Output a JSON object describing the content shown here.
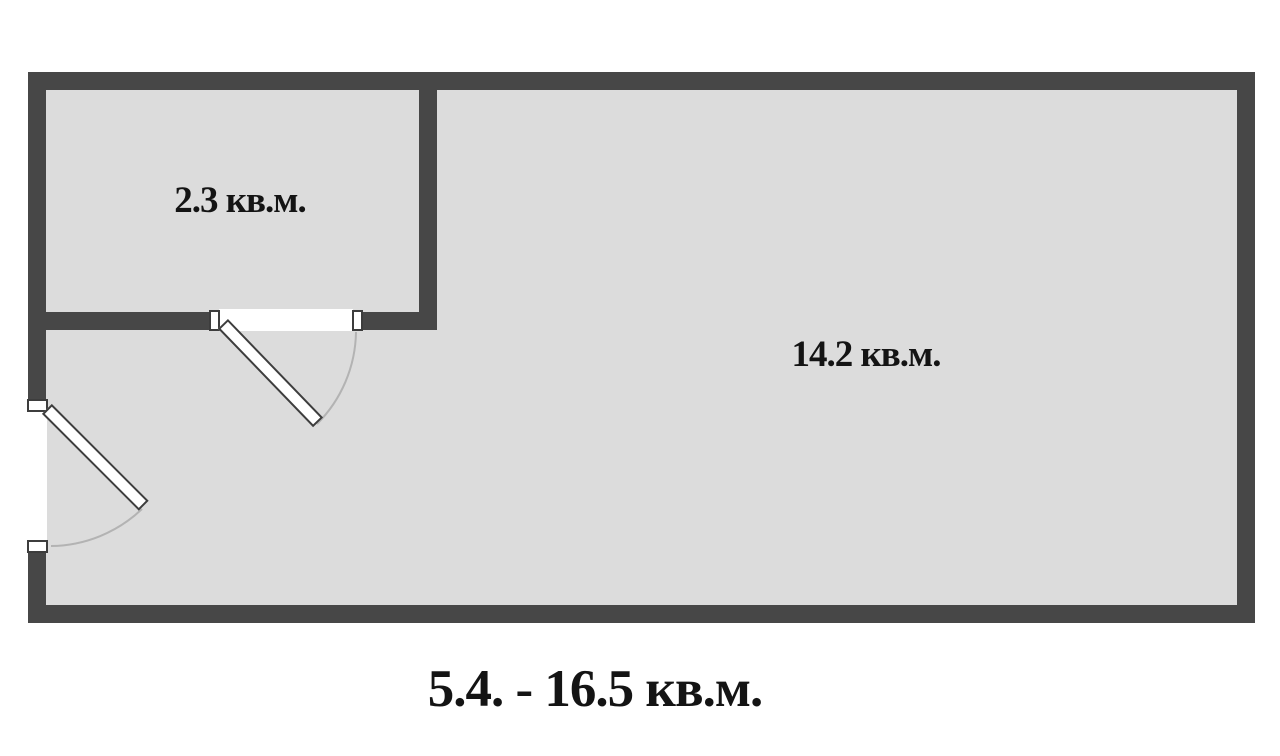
{
  "floor_plan": {
    "rooms": [
      {
        "id": "room-small",
        "area_label": "2.3 кв.м."
      },
      {
        "id": "room-large",
        "area_label": "14.2 кв.м."
      }
    ],
    "caption": "5.4. - 16.5 кв.м.",
    "doors": [
      {
        "id": "door-between-rooms",
        "location": "interior-horizontal-wall"
      },
      {
        "id": "entrance-door",
        "location": "left-exterior-wall"
      }
    ],
    "colors": {
      "wall": "#474747",
      "floor": "#dcdcdc",
      "background": "#ffffff",
      "door_opening": "#ffffff",
      "door_leaf_border": "#3d3d3d",
      "swing_arc": "#b3b3b3",
      "text": "#141414"
    }
  }
}
